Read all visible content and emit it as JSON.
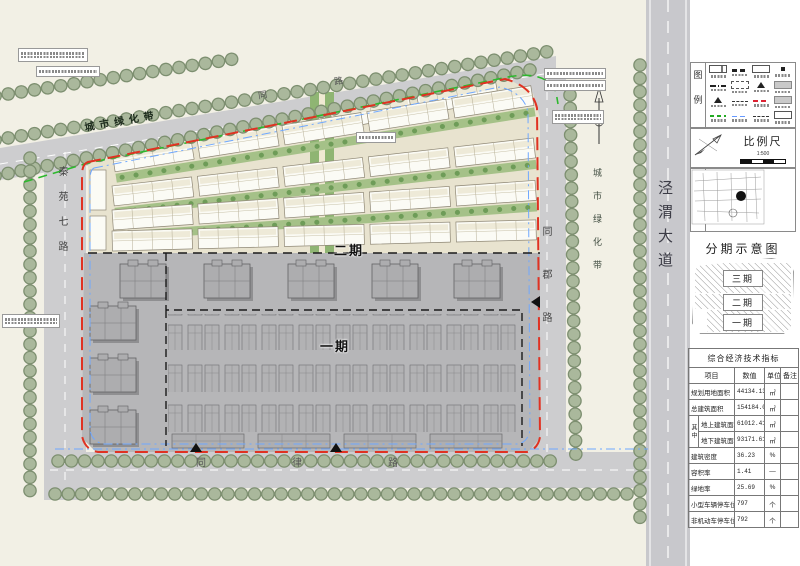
{
  "plan": {
    "labels": {
      "green_belt_top": "城市绿化带",
      "green_belt_right": "城市绿化带",
      "avenue_right": "泾渭大道",
      "road_left": "秦苑七路",
      "road_right": "同郡路",
      "road_bottom": "同律路",
      "road_top_chars": [
        "同",
        "路"
      ],
      "phase2": "二期",
      "phase1": "一期"
    }
  },
  "panel": {
    "legend_title": "图例",
    "scale_title": "比例尺",
    "scale_value": "1:500",
    "location_title": "区位图",
    "phasing_title": "分期示意图",
    "phases": [
      "三期",
      "二期",
      "一期"
    ]
  },
  "table": {
    "title": "综合经济技术指标",
    "headers": [
      "项目",
      "数值",
      "单位",
      "备注"
    ],
    "group_label": "其中",
    "rows": [
      {
        "item": "规划用地面积",
        "value": "44134.13",
        "unit": "㎡",
        "note": ""
      },
      {
        "item": "总建筑面积",
        "value": "154184.02",
        "unit": "㎡",
        "note": ""
      },
      {
        "item": "地上建筑面积",
        "value": "61012.41",
        "unit": "㎡",
        "note": ""
      },
      {
        "item": "地下建筑面积",
        "value": "93171.61",
        "unit": "㎡",
        "note": ""
      },
      {
        "item": "建筑密度",
        "value": "36.23",
        "unit": "%",
        "note": ""
      },
      {
        "item": "容积率",
        "value": "1.41",
        "unit": "—",
        "note": ""
      },
      {
        "item": "绿地率",
        "value": "25.69",
        "unit": "%",
        "note": ""
      },
      {
        "item": "小型车辆停车位",
        "value": "797",
        "unit": "个",
        "note": ""
      },
      {
        "item": "非机动车停车位",
        "value": "792",
        "unit": "个",
        "note": ""
      }
    ]
  },
  "colors": {
    "boundary_red": "#e03222",
    "greenline": "#2db82d",
    "blueline": "#6fa8ff",
    "tree_green": "#aab89c",
    "road_gray": "#cdcdcf",
    "phase1_gray": "#b6b6b8",
    "site_cream": "#e8e3cf"
  }
}
